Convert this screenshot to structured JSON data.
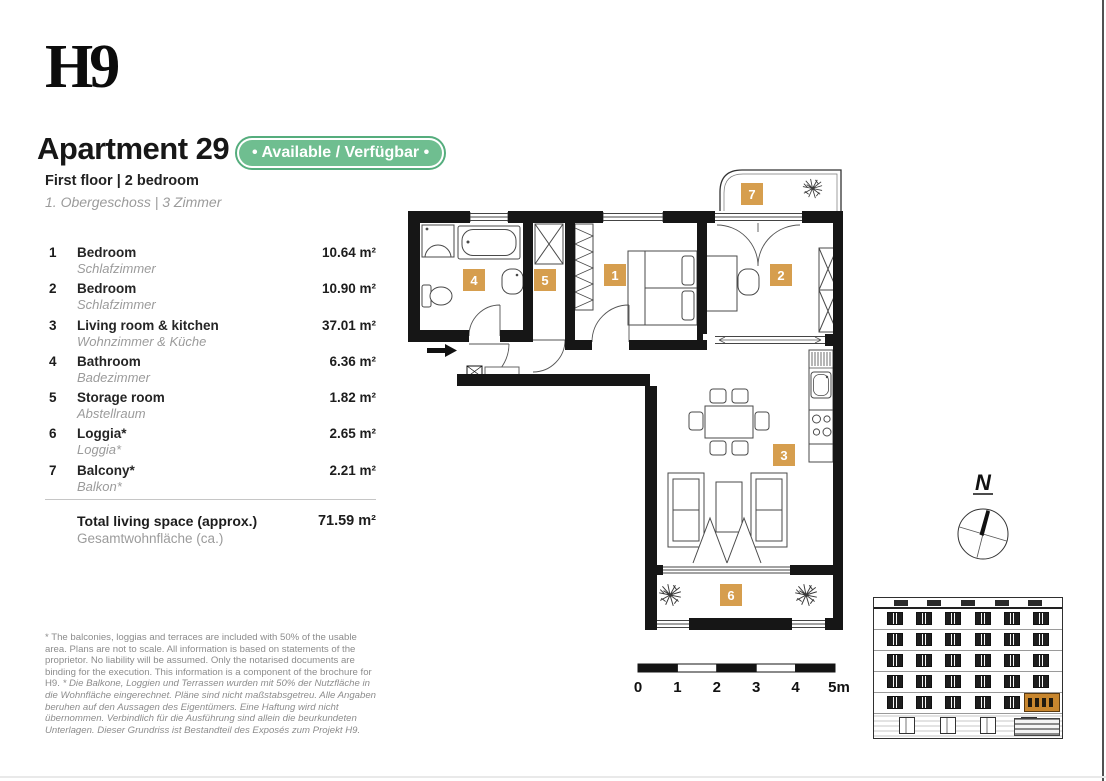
{
  "page": {
    "logo": "H9"
  },
  "header": {
    "title": "Apartment 29",
    "availability_badge": "• Available / Verfügbar •",
    "subtitle_en": "First floor | 2 bedroom",
    "subtitle_de": "1. Obergeschoss | 3 Zimmer"
  },
  "rooms": [
    {
      "num": "1",
      "name_en": "Bedroom",
      "name_de": "Schlafzimmer",
      "area": "10.64 m²"
    },
    {
      "num": "2",
      "name_en": "Bedroom",
      "name_de": "Schlafzimmer",
      "area": "10.90 m²"
    },
    {
      "num": "3",
      "name_en": "Living room & kitchen",
      "name_de": "Wohnzimmer & Küche",
      "area": "37.01 m²"
    },
    {
      "num": "4",
      "name_en": "Bathroom",
      "name_de": "Badezimmer",
      "area": "6.36 m²"
    },
    {
      "num": "5",
      "name_en": "Storage room",
      "name_de": "Abstellraum",
      "area": "1.82 m²"
    },
    {
      "num": "6",
      "name_en": "Loggia*",
      "name_de": "Loggia*",
      "area": "2.65 m²"
    },
    {
      "num": "7",
      "name_en": "Balcony*",
      "name_de": "Balkon*",
      "area": "2.21 m²"
    }
  ],
  "total": {
    "label_en": "Total living space (approx.)",
    "label_de": "Gesamtwohnfläche (ca.)",
    "area": "71.59 m²"
  },
  "footnote": {
    "en": "* The balconies, loggias and terraces are included with 50% of the usable area. Plans are not to scale. All information is based on statements of the proprietor. No liability will be assumed. Only the notarised documents are binding for the execution. This information is a component of the brochure for H9. ",
    "de": "* Die Balkone, Loggien und Terrassen wurden mit 50% der Nutzfläche in die Wohnfläche eingerechnet. Pläne sind nicht maßstabsgetreu. Alle Angaben beruhen auf den Aussagen des Eigentümers. Eine Haftung wird nicht übernommen. Verbindlich für die Ausführung sind allein die beurkundeten Unterlagen. Dieser Grundriss ist Bestandteil des Exposés zum Projekt H9."
  },
  "plan": {
    "room_labels": [
      "1",
      "2",
      "3",
      "4",
      "5",
      "6",
      "7"
    ],
    "compass_north_label": "N"
  },
  "scale_bar": {
    "labels": [
      "0",
      "1",
      "2",
      "3",
      "4",
      "5m"
    ]
  },
  "colors": {
    "badge_green": "#6fbe90",
    "badge_green_border": "#55ad7d",
    "room_badge_orange": "#d69e4e",
    "wall_black": "#161616",
    "gray_text": "#9b9b9b",
    "highlight_orange": "#c8862e"
  }
}
